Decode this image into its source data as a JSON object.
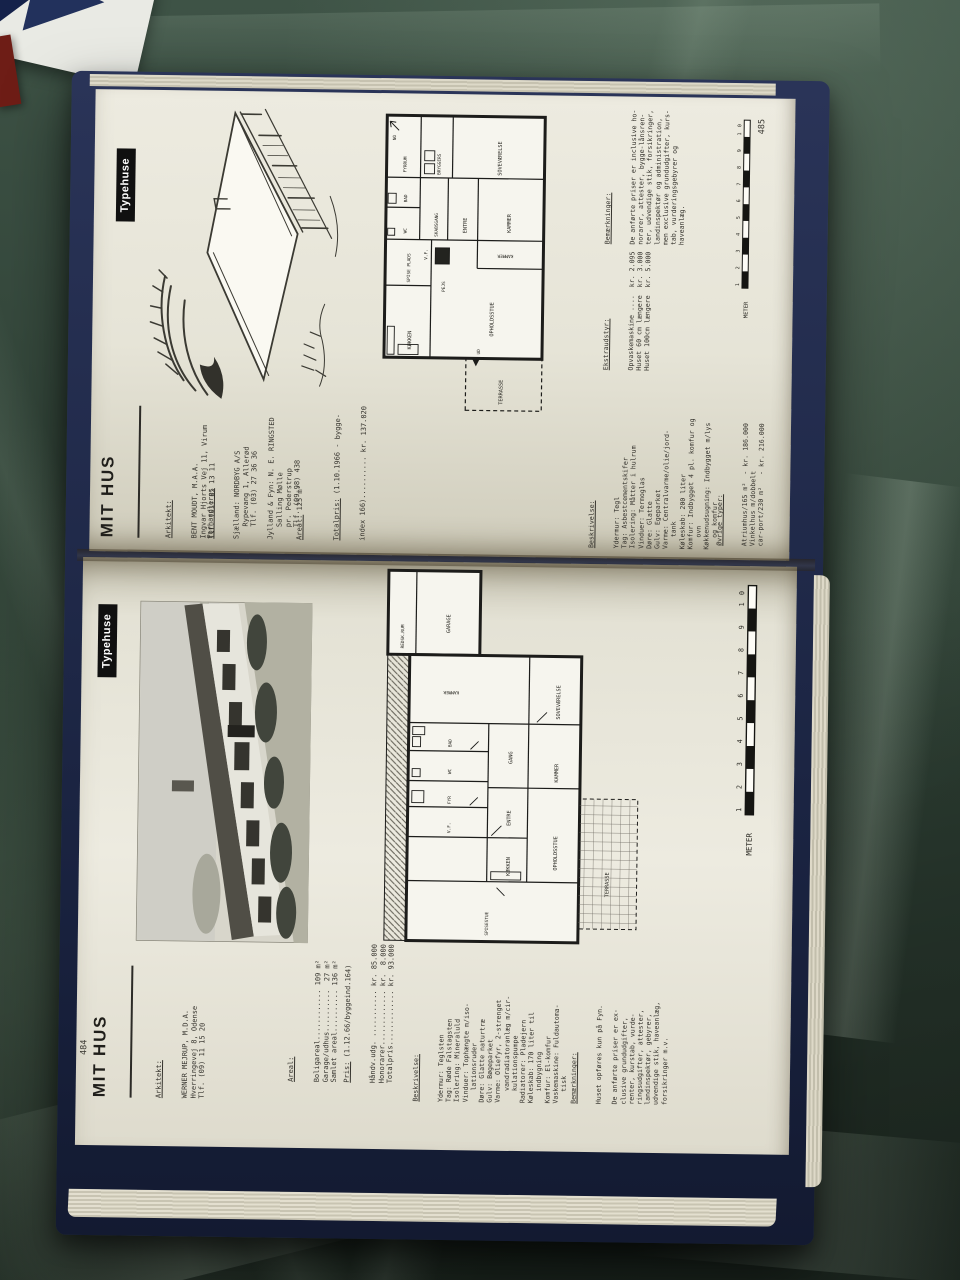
{
  "colors": {
    "tarp_green": "#35493c",
    "paper": "#e8e6da",
    "ink": "#34322c",
    "cover_navy": "#1e2a4c",
    "tab_bg": "#101010",
    "tab_fg": "#ffffff"
  },
  "p485": {
    "number": "485",
    "tab": "Typehuse",
    "masthead": "MIT HUS",
    "architect": {
      "heading": "Arkitekt:",
      "lines": [
        "BENT MOUDT, M.A.A.",
        "Ingvar Hjorts Vej 11, Virum",
        "Tlf. (01) 85 13 11"
      ]
    },
    "dealers": {
      "heading": "Forhandlere:",
      "lines": [
        "Sjælland: NORDBYG A/S",
        "   Rypevang 1, Allerød",
        "   Tlf. (03) 27 36 36",
        "",
        "Jylland & Fyn: N. E. RINGSTED",
        "   Salling Mølle",
        "   pr. Pederstrup",
        "   Tlf. (09-98) 438"
      ]
    },
    "areal_label": "Areal:",
    "areal_value": " 125 m²",
    "totalpris_label": "Totalpris:",
    "totalpris_rest": " (1.10.1966 - bygge-",
    "totalpris_line2": "index 166).......... kr. 137.020",
    "beskrivelse": {
      "heading": "Beskrivelse:",
      "lines": [
        "Ydermur: Tegl",
        "Tag: Asbestcementskifer",
        "Isolering: Måtter i hulrum",
        "Vinduer: Termoglas",
        "Døre: Glatte",
        "Gulv: Egeparket",
        "Varme: Centralvarme/olie/jord-",
        "   tank",
        "Køleskab: 200 liter",
        "Komfur: Indbygget 4 pl. komfur og",
        "   ovn",
        "Køkkenudsugning: Indbygget m/lys",
        "   og komfur"
      ]
    },
    "ekstraudstyr": {
      "heading": "Ekstraudstyr:",
      "lines": [
        "Opvaskemaskine ....  kr. 2.095",
        "Huset 60 cm længere  kr. 3.000",
        "Huset 100cm længere  kr. 5.000"
      ]
    },
    "bemaerkninger": {
      "heading": "Bemærkninger:",
      "lines": [
        "De anførte priser er inclusive ho-",
        "norarer, attester, bygge-lånsren-",
        "ter, udvendige stik, forsikringer,",
        "landinspektør og administration,",
        "men exclusive grundudgifter, kurs-",
        "tab, vurderingsgebyrer og",
        "haveanlæg."
      ]
    },
    "oevrige_typer": {
      "heading": "Øvrige typer:",
      "lines": [
        "Atriumhus/165 m²  - kr. 186.000",
        "Vinkelhus m/dobbelt",
        "car-port/230 m²   - kr. 216.000"
      ]
    },
    "ruler": {
      "label": "METER",
      "numbers": "1 2 3 4 5 6 7 8 9 10"
    },
    "plan": {
      "koekken": "KØKKEN",
      "spise_plads": "SPISE PLADS",
      "pejs": "PEJS",
      "ud": "UD",
      "opholdsstue": "OPHOLDSSTUE",
      "terrasse": "TERRASSE",
      "vf": "V.F.",
      "wc": "WC",
      "bad": "BAD",
      "skabsgang": "SKABSGANG",
      "entre": "ENTRE",
      "kammer_a": "KAMMER",
      "kammer_b": "KAMMER",
      "fyrrum": "FYRRUM",
      "bryggers": "BRYGGERS",
      "sovevaerelse": "SOVEVÆRELSE",
      "nord": "NO"
    }
  },
  "p484": {
    "number": "484",
    "tab": "Typehuse",
    "masthead": "MIT HUS",
    "architect": {
      "heading": "Arkitekt:",
      "lines": [
        "WERNER MEJRUP, M.D.A.",
        "Hverringevej 8, Odense",
        "Tlf. (09) 11 15 20"
      ]
    },
    "areal": {
      "heading": "Areal:",
      "lines": [
        "Boligareal............ 109 m²",
        "Garage/udhus..........  27 m²",
        "Samlet areal.......... 136 m²"
      ]
    },
    "pris_label": "Pris:",
    "pris_rest": " (1.12.66/byggeind.164)",
    "pris_lines": [
      "Håndv.udg. ........... kr. 85.000",
      "Honorarer............. kr.  8.000",
      "Totalpris............. kr. 93.000"
    ],
    "beskrivelse": {
      "heading": "Beskrivelse:",
      "lines": [
        "Ydermur: Teglsten",
        "Tag: Røde Falstagsten",
        "Isolering: Mineraluld",
        "Vinduer: Tophængte m/iso-",
        "   lationsruder",
        "Døre: Glatte naturtræ",
        "Gulv: Bøgeparket",
        "Varme: Oliefyr, 2-strenget",
        "   vandradiatoranlæg m/cir-",
        "   kulationspumpe",
        "Radiatorer: Pladejern",
        "Køleskab: 170 liter til",
        "   indbygning",
        "Komfur: El-komfur",
        "Vaskemaskine: Fuldautoma-",
        "   tisk"
      ]
    },
    "bemaerkninger": {
      "heading": "Bemærkninger:",
      "lines": [
        "Huset opføres kun på Fyn.",
        "",
        "De anførte priser er ex-",
        "clusive grundudgifter,",
        "renter, kurstab, vurde-",
        "ringsudgifter, attester,",
        "landinspektør, gebyrer,",
        "udvendige stik, haveanlæg,",
        "forsikringer m.v."
      ]
    },
    "ruler": {
      "label": "METER",
      "numbers": "1 2 3 4 5 6 7 8 9 10"
    },
    "plan": {
      "redskabsrum": "REDSK.RUM",
      "garage": "GARAGE",
      "kammer_a": "KAMMER",
      "sovevaerelse": "SOVEVÆRELSE",
      "vf": "V.F.",
      "fyr": "FYR",
      "wc": "WC",
      "bad": "BAD",
      "koekken": "KØKKEN",
      "entre": "ENTRE",
      "gang": "GANG",
      "spisestue": "SPISESTUE",
      "opholdsstue": "OPHOLDSSTUE",
      "kammer_b": "KAMMER",
      "terrasse": "TERRASSE"
    }
  }
}
